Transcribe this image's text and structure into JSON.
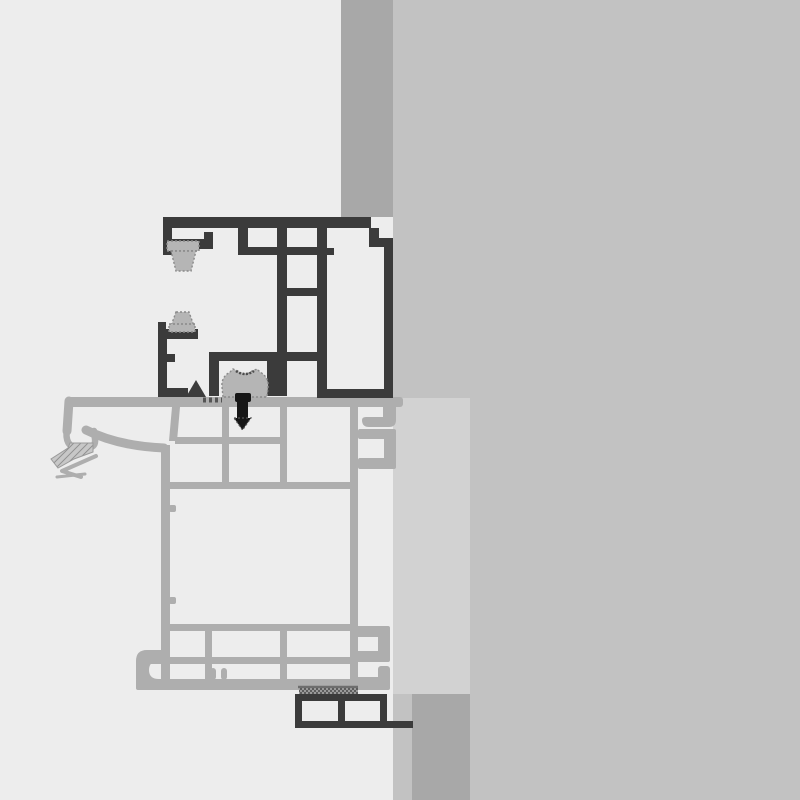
{
  "colors": {
    "bgLeft": "#ededed",
    "bgRight": "#c2c2c2",
    "masonry": "#a8a8a8",
    "panel": "#d2d2d2",
    "frame": "#3b3b3b",
    "sash": "#aeaeae",
    "seal": "#b5b5b5",
    "sealEdge": "#8a8a8a",
    "screw": "#161616",
    "hatch": "#555555"
  },
  "scene": {
    "kind": "cad-cross-section",
    "description": "Technical cross-section detail of window frame profiles mounted against a wall",
    "components": [
      {
        "id": "wall-background",
        "label": "wall background (right)"
      },
      {
        "id": "masonry-band-top",
        "label": "masonry band (top)"
      },
      {
        "id": "reveal-panel",
        "label": "reveal panel"
      },
      {
        "id": "masonry-block-bottom",
        "label": "masonry block (bottom)"
      },
      {
        "id": "frame-profile",
        "label": "guide frame profile (dark)"
      },
      {
        "id": "brush-seal-upper",
        "label": "upper brush seal"
      },
      {
        "id": "brush-seal-lower",
        "label": "lower brush seal"
      },
      {
        "id": "glazing-clamp",
        "label": "clamp block"
      },
      {
        "id": "fixing-screw",
        "label": "fixing screw"
      },
      {
        "id": "sash-profile",
        "label": "sash / sill profile (grey)"
      },
      {
        "id": "rubber-gasket",
        "label": "flexible gasket (left)"
      },
      {
        "id": "sealing-tape",
        "label": "sealing tape strips"
      },
      {
        "id": "mounting-bracket",
        "label": "mounting bracket (bottom)"
      }
    ]
  }
}
